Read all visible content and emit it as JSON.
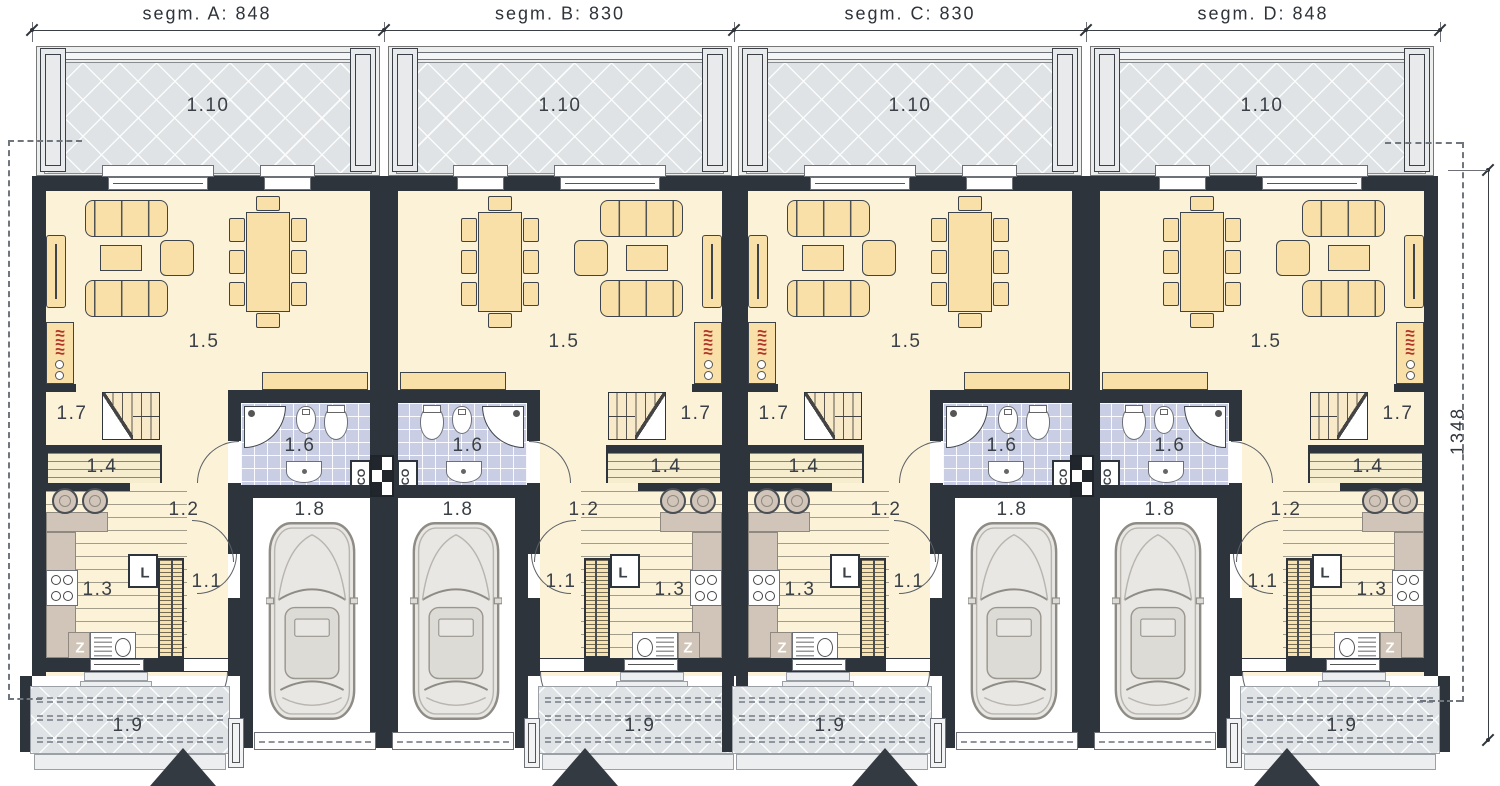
{
  "drawing_type": "ground floor plan - four segment row house",
  "dimensions": {
    "top": [
      {
        "label": "segm. A: 848"
      },
      {
        "label": "segm. B: 830"
      },
      {
        "label": "segm. C: 830"
      },
      {
        "label": "segm. D: 848"
      }
    ],
    "right_label": "1348"
  },
  "rooms": {
    "entry": "1.1",
    "hall": "1.2",
    "kitchen": "1.3",
    "storage": "1.4",
    "living": "1.5",
    "bathroom": "1.6",
    "stairs": "1.7",
    "garage": "1.8",
    "porch": "1.9",
    "terrace": "1.10"
  },
  "appliances": {
    "fridge": "L",
    "sink_unit": "Z",
    "boiler": "CO"
  },
  "segments": [
    {
      "name": "segment-a",
      "left": 32,
      "dim_center": 207,
      "flip": false
    },
    {
      "name": "segment-b",
      "left": 384,
      "dim_center": 560,
      "flip": true
    },
    {
      "name": "segment-c",
      "left": 734,
      "dim_center": 910,
      "flip": false
    },
    {
      "name": "segment-d",
      "left": 1086,
      "dim_center": 1263,
      "flip": true
    }
  ],
  "colors": {
    "wall": "#2d343c",
    "room_fill": "#fbf2d8",
    "furniture": "#f8e0a8",
    "bath_tile": "#c9cee4",
    "terrace": "#e0e3e6",
    "counter": "#d0c5b8",
    "fireplace_flame": "#b23327",
    "dash": "#8e959c"
  }
}
